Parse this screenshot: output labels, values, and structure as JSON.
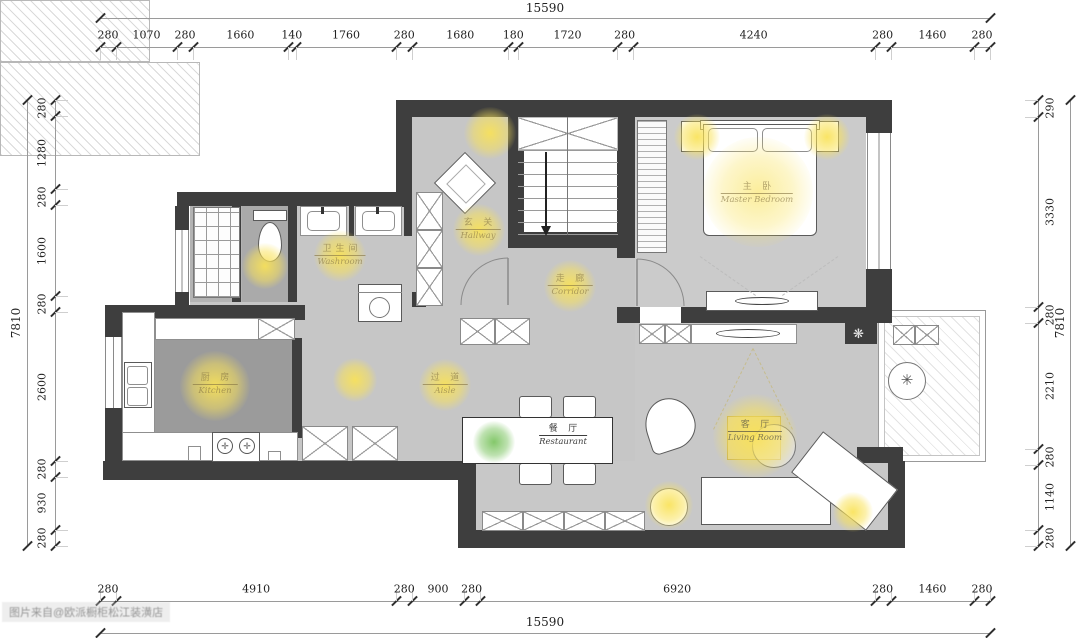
{
  "dimensions": {
    "top": {
      "total": "15590",
      "segments": [
        280,
        1070,
        280,
        1660,
        140,
        1760,
        280,
        1680,
        180,
        1720,
        280,
        4240,
        280,
        1460,
        280
      ]
    },
    "bottom": {
      "total": "15590",
      "segments": [
        280,
        4910,
        280,
        900,
        280,
        6920,
        280,
        1460,
        280
      ]
    },
    "left": {
      "total": "7810",
      "segments": [
        280,
        1280,
        280,
        1600,
        280,
        2600,
        280,
        930,
        280
      ]
    },
    "right": {
      "total": "7810",
      "segments": [
        290,
        3330,
        280,
        2210,
        280,
        1140,
        280
      ]
    }
  },
  "rooms": {
    "master_bedroom": {
      "cn": "主 卧",
      "en": "Master Bedroom"
    },
    "living_room": {
      "cn": "客 厅",
      "en": "Living Room"
    },
    "restaurant": {
      "cn": "餐 厅",
      "en": "Restaurant"
    },
    "corridor": {
      "cn": "走 廊",
      "en": "Corridor"
    },
    "washroom": {
      "cn": "卫生间",
      "en": "Washroom"
    },
    "kitchen": {
      "cn": "厨 房",
      "en": "Kitchen"
    },
    "aisle": {
      "cn": "过 道",
      "en": "Aisle"
    },
    "hallway": {
      "cn": "玄 关",
      "en": "Hallway"
    }
  },
  "watermark": "图片来自@欧派橱柜松江装潢店",
  "colors": {
    "wall": "#3e3e3e",
    "floor": "#c8c8c8",
    "floor_dark": "#9b9b9b",
    "light_glow": "#f9e258",
    "plant_green": "#6ebe50",
    "dim_text": "#222222"
  }
}
